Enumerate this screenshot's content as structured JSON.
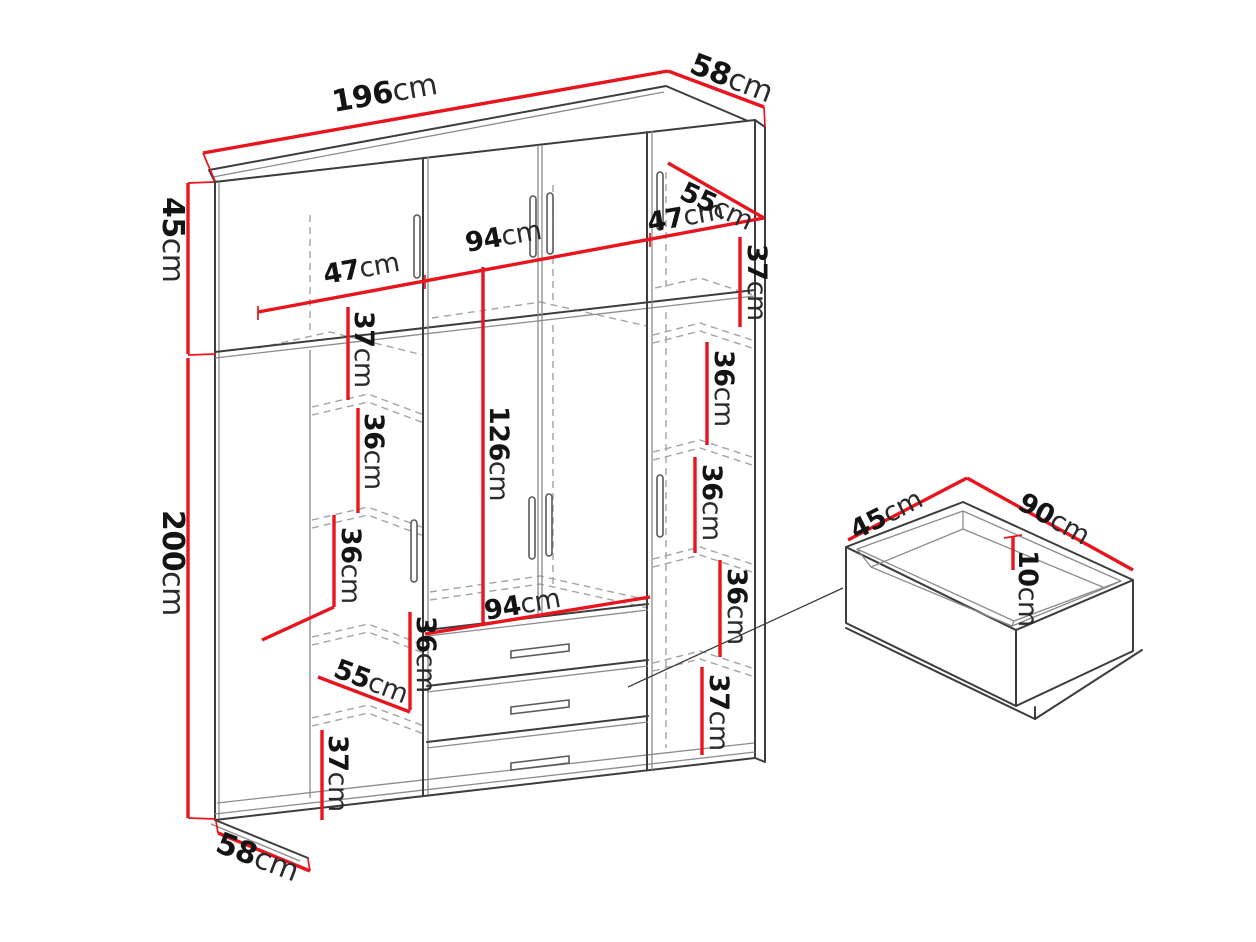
{
  "diagram": {
    "kind": "furniture-dimension-drawing",
    "subject": "wardrobe with drawers and pull-out drawer detail",
    "unit": "cm",
    "colors": {
      "dimension_red": "#e8151e",
      "outline": "#3d3d3d",
      "dashed_interior": "#a3a3a3",
      "background": "#ffffff",
      "text": "#141414"
    }
  },
  "dims": {
    "overall": {
      "width": {
        "num": "196",
        "unit": "cm"
      },
      "top_depth": {
        "num": "58",
        "unit": "cm"
      },
      "upper_height": {
        "num": "45",
        "unit": "cm"
      },
      "main_height": {
        "num": "200",
        "unit": "cm"
      },
      "base_depth": {
        "num": "58",
        "unit": "cm"
      }
    },
    "upper_cabinet": {
      "left_width": {
        "num": "47",
        "unit": "cm"
      },
      "middle_width": {
        "num": "94",
        "unit": "cm"
      },
      "right_width": {
        "num": "47",
        "unit": "cm"
      },
      "depth": {
        "num": "55",
        "unit": "cm"
      }
    },
    "left_column": {
      "shelf1": {
        "num": "37",
        "unit": "cm"
      },
      "shelf2": {
        "num": "36",
        "unit": "cm"
      },
      "shelf3": {
        "num": "36",
        "unit": "cm"
      },
      "shelf_depth": {
        "num": "55",
        "unit": "cm"
      },
      "shelf4": {
        "num": "36",
        "unit": "cm"
      },
      "shelf5": {
        "num": "37",
        "unit": "cm"
      }
    },
    "middle_section": {
      "hanging_height": {
        "num": "126",
        "unit": "cm"
      },
      "width": {
        "num": "94",
        "unit": "cm"
      }
    },
    "right_column": {
      "shelf1": {
        "num": "37",
        "unit": "cm"
      },
      "shelf2": {
        "num": "36",
        "unit": "cm"
      },
      "shelf3": {
        "num": "36",
        "unit": "cm"
      },
      "shelf4": {
        "num": "36",
        "unit": "cm"
      },
      "shelf5": {
        "num": "37",
        "unit": "cm"
      }
    },
    "drawer_detail": {
      "depth": {
        "num": "45",
        "unit": "cm"
      },
      "width": {
        "num": "90",
        "unit": "cm"
      },
      "inner_height": {
        "num": "10",
        "unit": "cm"
      }
    }
  }
}
